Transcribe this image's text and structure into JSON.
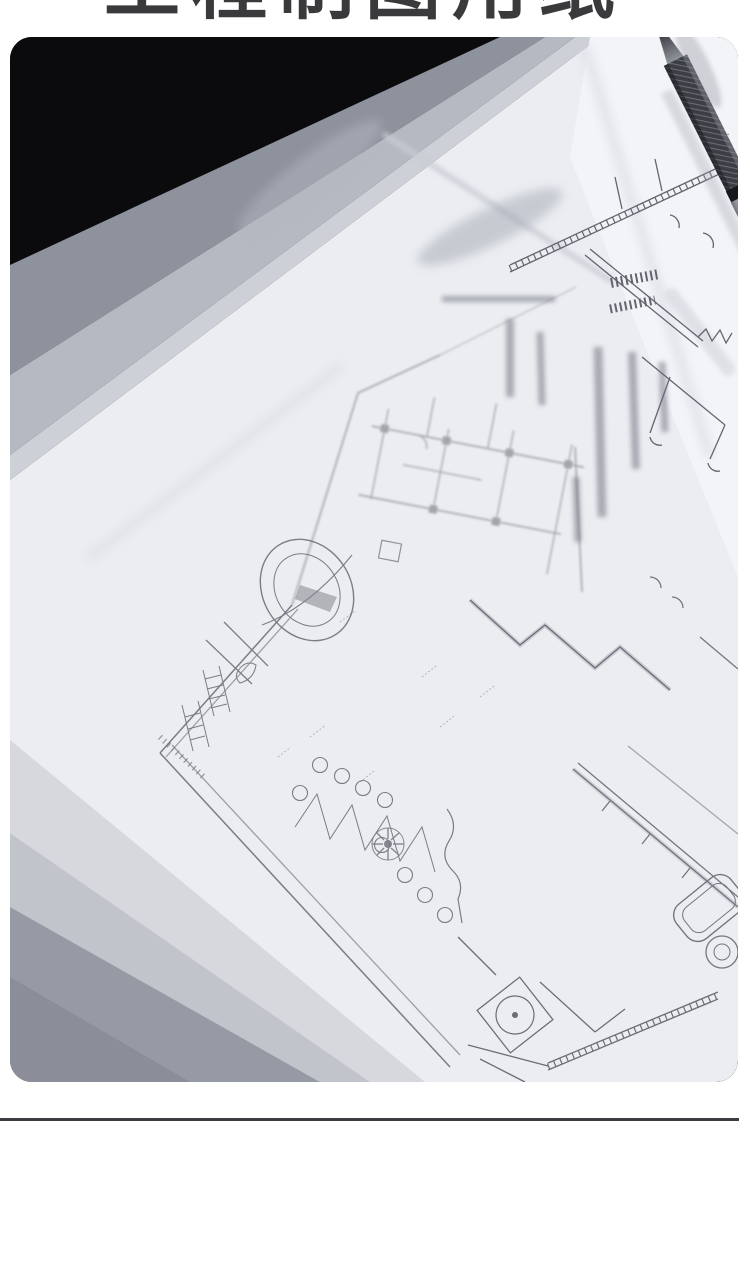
{
  "theme": {
    "heading-color": "#3a3a3d",
    "divider-color": "#3c3d40",
    "photo-bg": "#0b0b0e",
    "page-bg": "#ffffff"
  },
  "heading": {
    "text": "工程制图用纸"
  },
  "photo": {
    "label": "tracing-paper-sheets-over-architectural-blueprint-with-drafting-pencil",
    "paper_stack": {
      "top_edge_band_colors": [
        "#8e929d",
        "#b6b9c1",
        "#cdd0d7"
      ],
      "main_sheet_color": "#ebedf1",
      "top_right_paper_color": "#f3f4f8",
      "bottom_edge_band_colors": [
        "#d6d8de",
        "#c2c4cc",
        "#969aa4"
      ]
    },
    "blueprint_line_color": "#4b4e58",
    "pencil": {
      "tip_size_label": ".5",
      "barrel_color": "#c9ccd3",
      "grip_color": "#3c3e44"
    }
  }
}
